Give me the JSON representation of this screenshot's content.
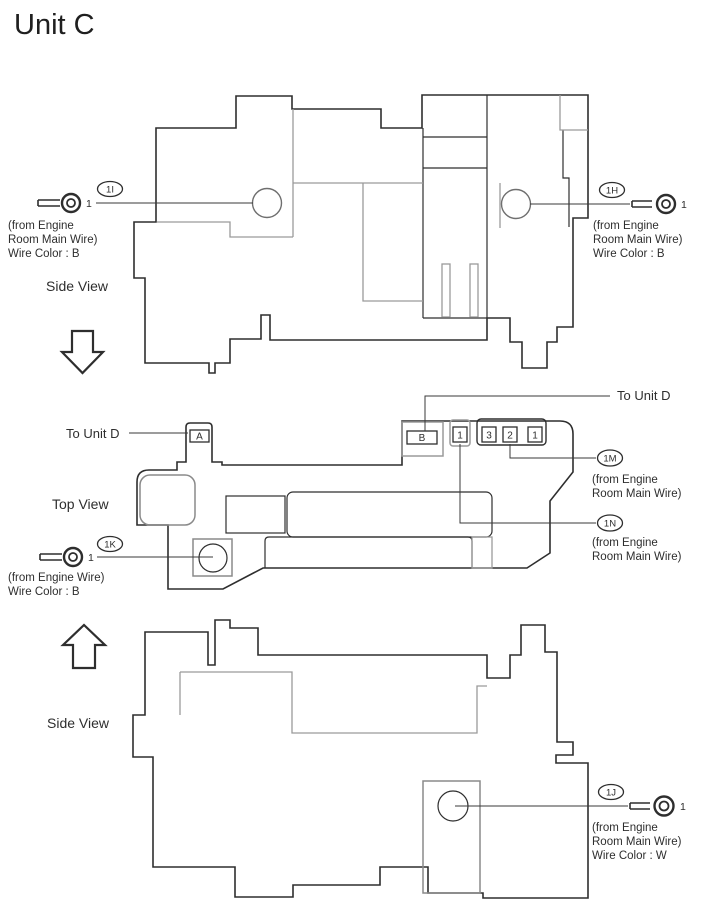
{
  "title": "Unit C",
  "colors": {
    "outline": "#2e2e2e",
    "internal_gray": "#9a9a9a",
    "background": "#ffffff"
  },
  "top_side_view": {
    "label": "Side View",
    "callout_left": {
      "tag": "1I",
      "terminal_number": "1",
      "note_lines": [
        "(from Engine",
        "Room Main Wire)",
        "Wire Color : B"
      ]
    },
    "callout_right": {
      "tag": "1H",
      "terminal_number": "1",
      "note_lines": [
        "(from Engine",
        "Room Main Wire)",
        "Wire Color : B"
      ]
    }
  },
  "top_view": {
    "label": "Top View",
    "to_unit_d_left": "To Unit D",
    "to_unit_d_right": "To Unit D",
    "connector_a_label": "A",
    "connector_b_label": "B",
    "single_connector_label": "1",
    "connector_group_labels": [
      "3",
      "2",
      "1"
    ],
    "callout_1k": {
      "tag": "1K",
      "terminal_number": "1",
      "note_lines": [
        "(from Engine Wire)",
        "Wire Color : B"
      ]
    },
    "callout_1m": {
      "tag": "1M",
      "note_lines": [
        "(from Engine",
        "Room Main Wire)"
      ]
    },
    "callout_1n": {
      "tag": "1N",
      "note_lines": [
        "(from Engine",
        "Room Main Wire)"
      ]
    }
  },
  "bottom_side_view": {
    "label": "Side View",
    "callout_1j": {
      "tag": "1J",
      "terminal_number": "1",
      "note_lines": [
        "(from Engine",
        "Room Main Wire)",
        "Wire Color : W"
      ]
    }
  }
}
